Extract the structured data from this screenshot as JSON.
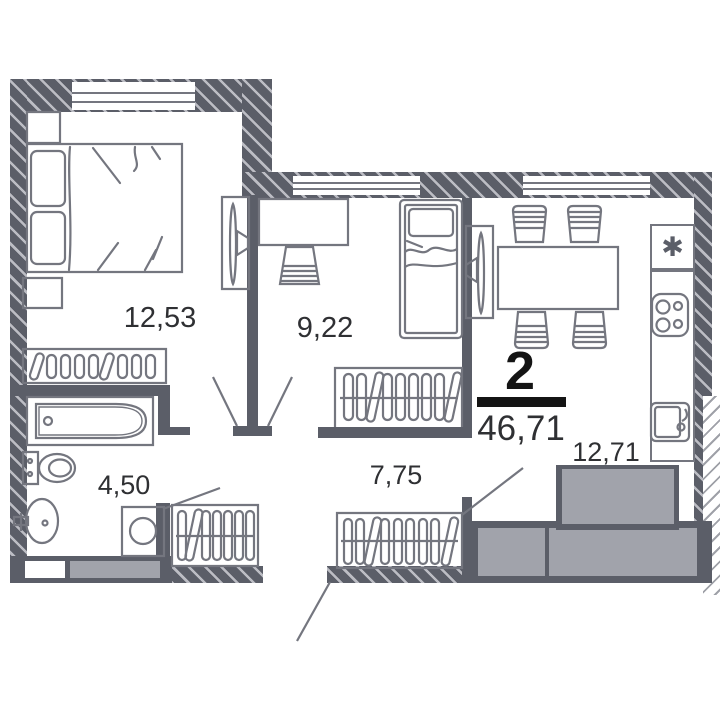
{
  "plan": {
    "type_label": "2",
    "total_area": "46,71",
    "rooms": [
      {
        "name": "bedroom",
        "area": "12,53"
      },
      {
        "name": "room",
        "area": "9,22"
      },
      {
        "name": "bathroom",
        "area": "4,50"
      },
      {
        "name": "hallway",
        "area": "7,75"
      },
      {
        "name": "kitchen-living",
        "area": "12,71"
      }
    ],
    "icons": {
      "fridge_symbol": "✱"
    },
    "colors": {
      "wall": "#5b5e68",
      "hatch_stripe": "#bcbdc4",
      "furniture_line": "#74767f",
      "block_gray": "#a1a3ab",
      "text": "#2f3033",
      "accent": "#141414"
    }
  }
}
